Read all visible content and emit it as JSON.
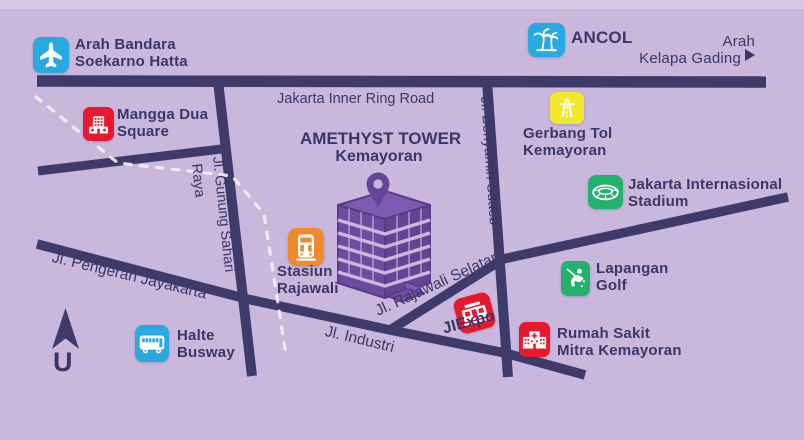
{
  "title": {
    "line1": "AMETHYST TOWER",
    "line2": "Kemayoran"
  },
  "compass": {
    "label": "U"
  },
  "colors": {
    "background": "#c9b7dc",
    "road": "#3e3b6b",
    "text": "#3a3768",
    "railway": "#f2eef7",
    "building_purple": "#6b4c9e",
    "blue": "#29a9e0",
    "red": "#e8192c",
    "orange": "#f18a2d",
    "yellow": "#f2e72a",
    "green": "#22b26b"
  },
  "roads": {
    "inner_ring": "Jakarta Inner Ring Road",
    "gunung_sahari": "Jl. Gunung Sahari",
    "gunung_sahari_2": "Raya",
    "benyamin_suaeb": "Jl. Benyamin Suaeb",
    "pengeran_jayakarta": "Jl. Pengeran Jayakarta",
    "industri": "Jl. Industri",
    "rajawali_selatan": "Jl. Rajawali Selatan"
  },
  "pois": [
    {
      "id": "bandara",
      "icon": "airplane-icon",
      "color": "#29a9e0",
      "line1": "Arah Bandara",
      "line2": "Soekarno Hatta"
    },
    {
      "id": "mangga-dua",
      "icon": "mall-icon",
      "color": "#e8192c",
      "line1": "Mangga Dua",
      "line2": "Square"
    },
    {
      "id": "ancol",
      "icon": "palm-trees-icon",
      "color": "#29a9e0",
      "line1": "ANCOL"
    },
    {
      "id": "kelapa-gading",
      "icon": "arrow-right-icon",
      "color": "#3a3768",
      "line1": "Arah",
      "line2": "Kelapa Gading"
    },
    {
      "id": "gerbang-tol",
      "icon": "highway-icon",
      "color": "#f2e72a",
      "line1": "Gerbang Tol",
      "line2": "Kemayoran"
    },
    {
      "id": "jis",
      "icon": "stadium-icon",
      "color": "#22b26b",
      "line1": "Jakarta Internasional",
      "line2": "Stadium"
    },
    {
      "id": "lapangan-golf",
      "icon": "golfer-icon",
      "color": "#22b26b",
      "line1": "Lapangan",
      "line2": "Golf"
    },
    {
      "id": "stasiun",
      "icon": "train-icon",
      "color": "#f18a2d",
      "line1": "Stasiun",
      "line2": "Rajawali"
    },
    {
      "id": "halte-busway",
      "icon": "bus-icon",
      "color": "#29a9e0",
      "line1": "Halte",
      "line2": "Busway"
    },
    {
      "id": "jiexpo",
      "icon": "expo-icon",
      "color": "#e8192c",
      "line1": "JIExpo"
    },
    {
      "id": "rs-mitra",
      "icon": "hospital-icon",
      "color": "#e8192c",
      "line1": "Rumah Sakit",
      "line2": "Mitra Kemayoran"
    }
  ]
}
